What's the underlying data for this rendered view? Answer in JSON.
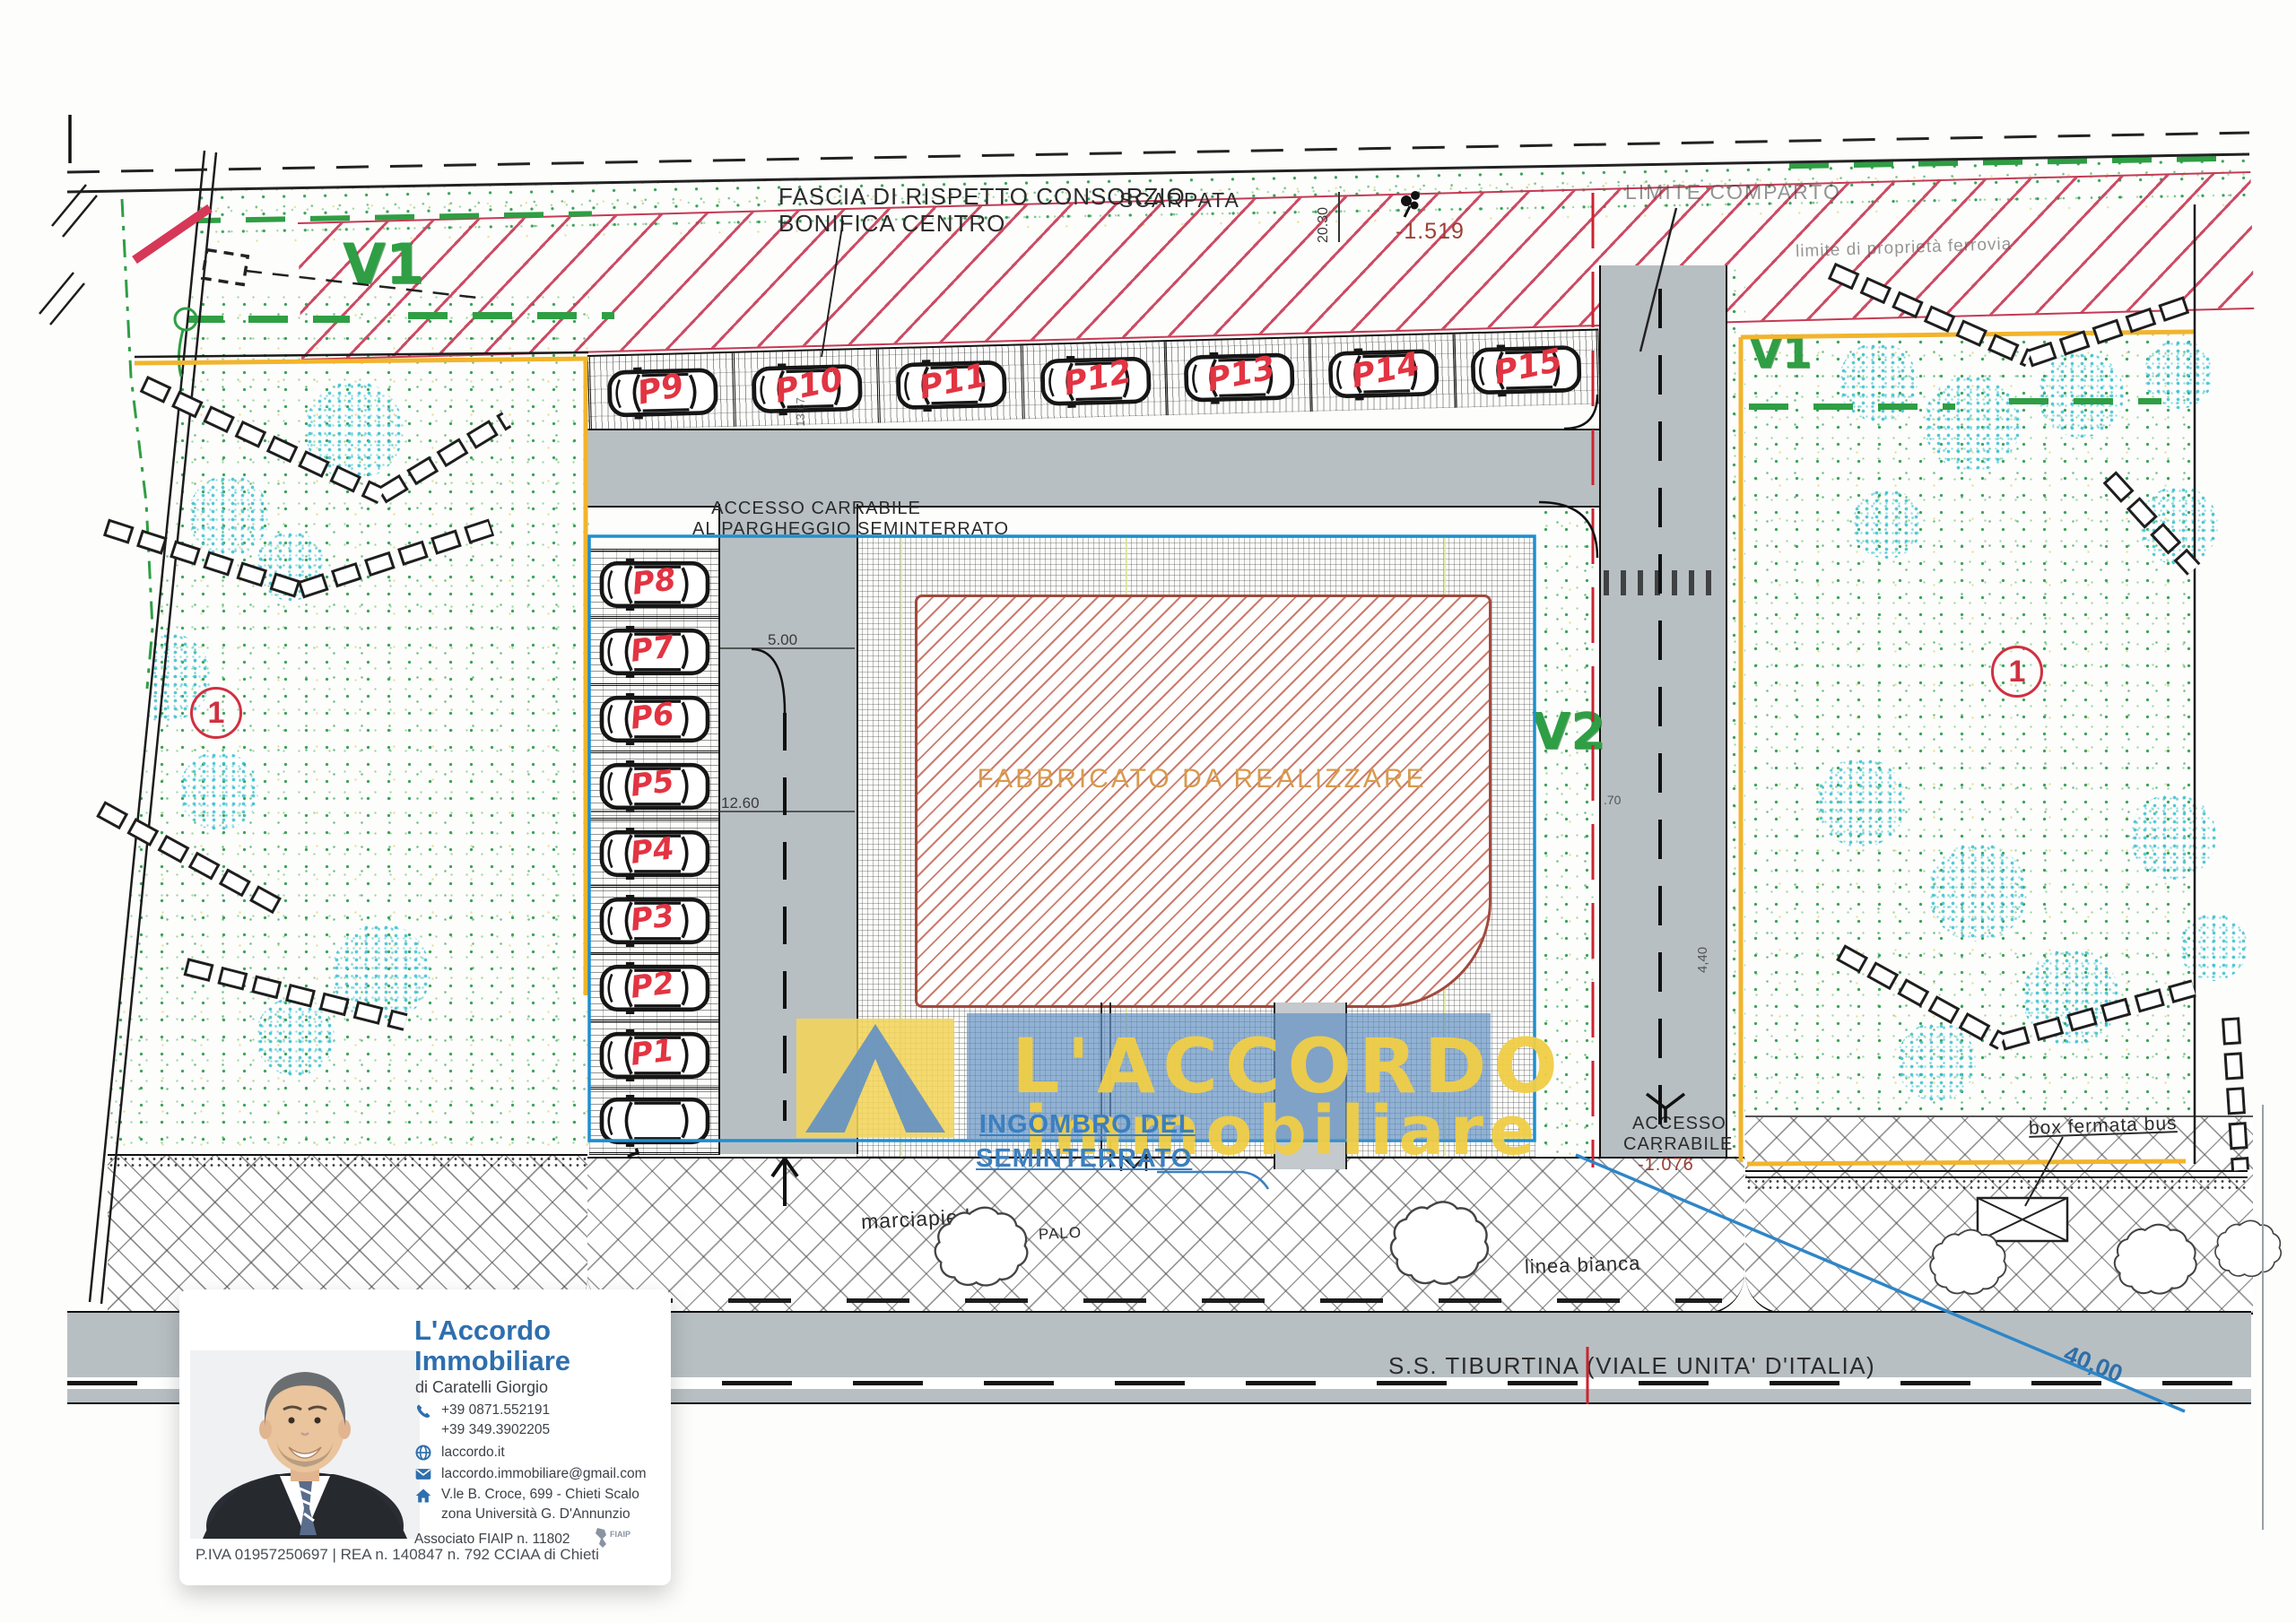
{
  "plan": {
    "top_labels": {
      "fascia_line1": "FASCIA DI RISPETTO CONSORZIO",
      "fascia_line2": "BONIFICA CENTRO",
      "scarpata": "SCARPATA",
      "limite_comparto": "LIMITE COMPARTO",
      "limite_ferrovia": "limite di proprietà ferrovia",
      "quota_scarpata": "-1.519"
    },
    "zones": {
      "v1_left": "V1",
      "v1_right": "V1",
      "v2": "V2",
      "lot_left": "1",
      "lot_right": "1"
    },
    "building": {
      "label": "FABBRICATO DA REALIZZARE"
    },
    "seminterrato": {
      "line1": "INGOMBRO DEL",
      "line2": "SEMINTERRATO"
    },
    "access_top": {
      "line1": "ACCESSO CARRABILE",
      "line2": "AL PARGHEGGIO SEMINTERRATO"
    },
    "access_right": {
      "line1": "ACCESSO",
      "line2": "CARRABILE",
      "quota": "-1.076"
    },
    "street": {
      "name": "S.S. TIBURTINA (VIALE UNITA' D'ITALIA)"
    },
    "street_furniture": {
      "marciapiede": "marciapiede",
      "palo": "PALO",
      "linea_bianca": "linea bianca",
      "box_fermata_bus": "box fermata bus"
    },
    "dimensions": {
      "d2030": "20.30",
      "d1367": "13.67",
      "d500": "5.00",
      "d1260": "12.60",
      "d070": ".70",
      "d440": "4,40",
      "d4000": "40,00"
    },
    "parking": {
      "row_top": [
        "P9",
        "P10",
        "P11",
        "P12",
        "P13",
        "P14",
        "P15"
      ],
      "column_left": [
        "P8",
        "P7",
        "P6",
        "P5",
        "P4",
        "P3",
        "P2",
        "P1"
      ]
    }
  },
  "watermark": {
    "line1": "L'ACCORDO",
    "line2": "immobiliare"
  },
  "card": {
    "agency_line1": "L'Accordo",
    "agency_line2": "Immobiliare",
    "owner": "di Caratelli Giorgio",
    "phone1": "+39 0871.552191",
    "phone2": "+39 349.3902205",
    "website": "laccordo.it",
    "email": "laccordo.immobiliare@gmail.com",
    "address1": "V.le B. Croce, 699 - Chieti Scalo",
    "address2": "zona Università G. D'Annunzio",
    "association": "Associato FIAIP n. 11802",
    "association_logo": "fiaip-italy-icon",
    "vat": "P.IVA 01957250697 | REA n. 140847 n. 792 CCIAA di Chieti"
  },
  "colors": {
    "accent_blue": "#2e6fad",
    "plan_red_hatch": "#c43a54",
    "plan_green": "#2f9e44",
    "road_gray": "#b8bfc2",
    "boundary_yellow": "#f2b42c",
    "watermark_yellow": "#f0ce46",
    "watermark_blue": "#6491c3",
    "handwriting_red": "#e23442",
    "quota_red": "#9c3f35",
    "blue_line": "#2e86c8"
  }
}
